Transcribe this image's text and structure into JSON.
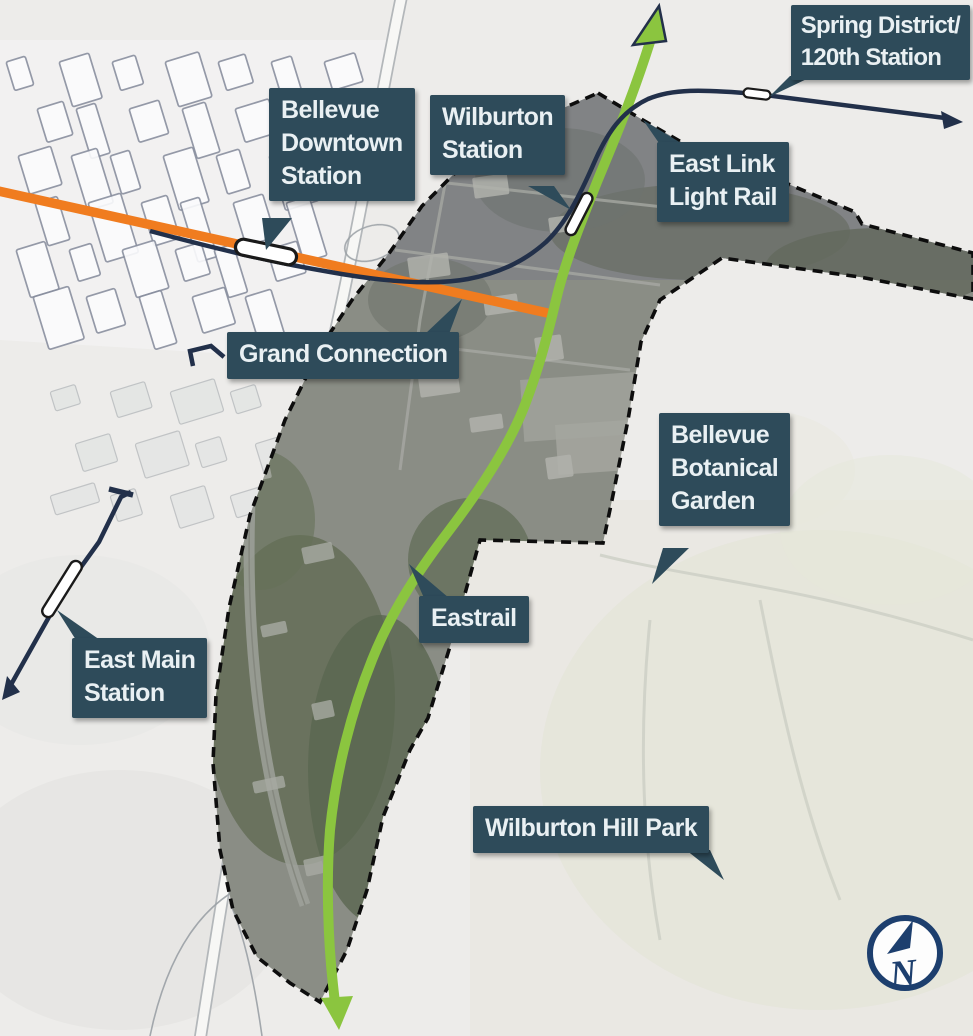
{
  "labels": {
    "bellevue_downtown_station": {
      "lines": [
        "Bellevue",
        "Downtown",
        "Station"
      ]
    },
    "wilburton_station": {
      "lines": [
        "Wilburton",
        "Station"
      ]
    },
    "spring_district_station": {
      "lines": [
        "Spring District/",
        "120th Station"
      ]
    },
    "east_link_light_rail": {
      "lines": [
        "East Link",
        "Light Rail"
      ]
    },
    "grand_connection": {
      "lines": [
        "Grand Connection"
      ]
    },
    "bellevue_botanical_garden": {
      "lines": [
        "Bellevue",
        "Botanical",
        "Garden"
      ]
    },
    "eastrail": {
      "lines": [
        "Eastrail"
      ]
    },
    "east_main_station": {
      "lines": [
        "East Main",
        "Station"
      ]
    },
    "wilburton_hill_park": {
      "lines": [
        "Wilburton Hill Park"
      ]
    }
  },
  "compass": {
    "label": "N"
  },
  "colors": {
    "callout_bg": "#2e4b5a",
    "callout_text": "#e9f0f3",
    "eastrail_green": "#8bc53f",
    "grand_connection_orange": "#f07c1f",
    "light_rail_navy": "#22304a",
    "boundary_black": "#0d0d0d",
    "compass_navy": "#1d3f6e",
    "station_marker_fill": "#ffffff",
    "station_marker_border": "#1a1a1a"
  }
}
